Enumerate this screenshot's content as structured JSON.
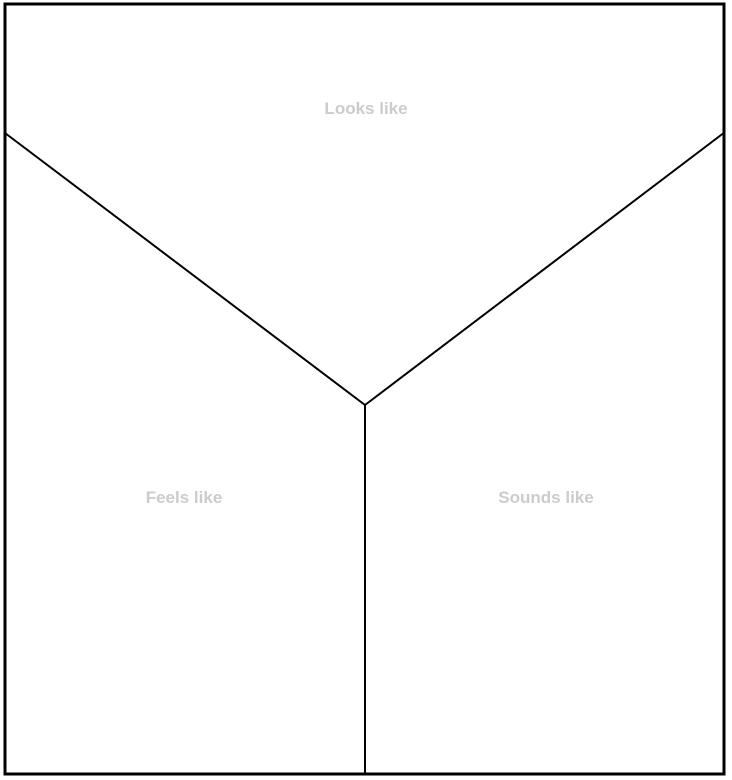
{
  "diagram": {
    "type": "y-chart",
    "sections": [
      {
        "id": "looks-like",
        "label": "Looks like"
      },
      {
        "id": "feels-like",
        "label": "Feels like"
      },
      {
        "id": "sounds-like",
        "label": "Sounds like"
      }
    ],
    "colors": {
      "line": "#000000",
      "placeholder_label": "#cccccc",
      "background": "#ffffff"
    }
  }
}
